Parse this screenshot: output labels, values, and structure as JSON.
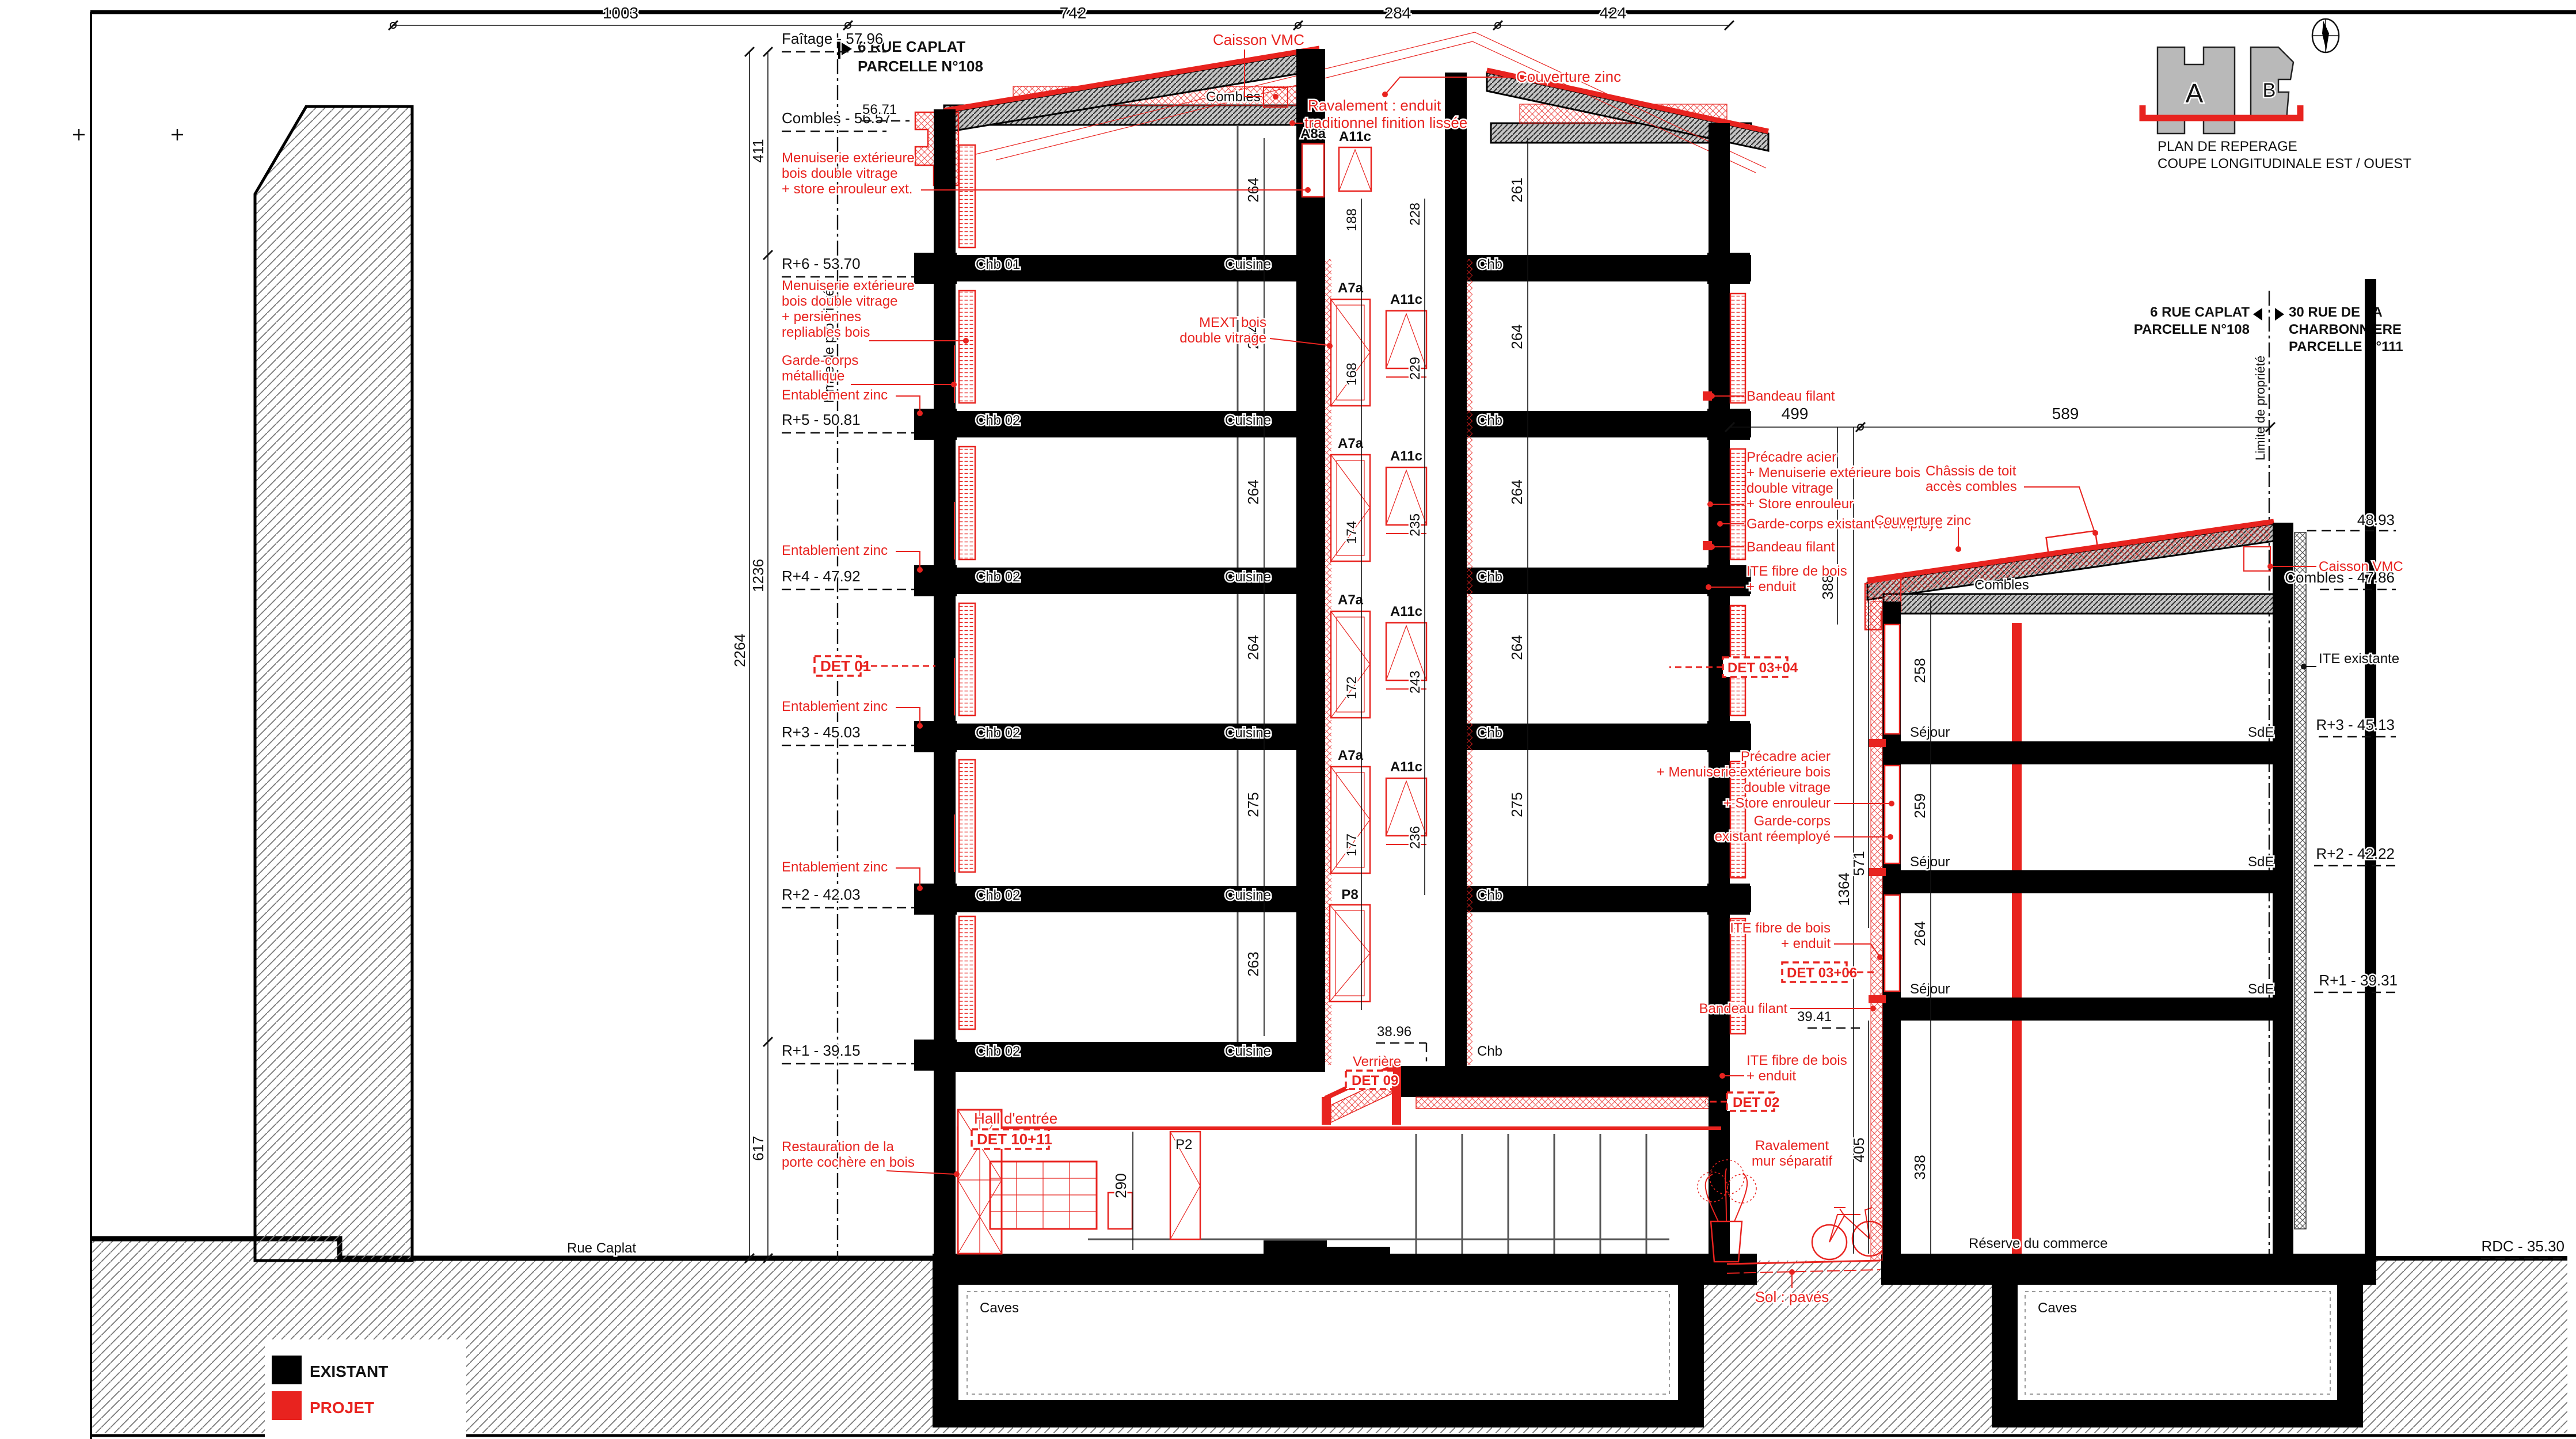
{
  "colors": {
    "project": "#e8231f",
    "existing": "#000000"
  },
  "legend": {
    "existing": "EXISTANT",
    "project": "PROJET"
  },
  "street": "Rue Caplat",
  "key_plan": {
    "line1": "PLAN DE REPERAGE",
    "line2": "COUPE LONGITUDINALE EST / OUEST",
    "block_a": "A",
    "block_b": "B"
  },
  "parcels": {
    "left_street": "6 RUE CAPLAT",
    "left_parcel": "PARCELLE N°108",
    "right_street1": "30 RUE DE LA",
    "right_street2": "CHARBONNIERE",
    "right_parcel": "PARCELLE N°111",
    "limit": "Limite de propriété"
  },
  "top_dims": {
    "d1": "1003",
    "d2": "742",
    "d3": "284",
    "d4": "424"
  },
  "left_dims": {
    "d1": "411",
    "d2": "1236",
    "d3": "2264",
    "d4": "617"
  },
  "levels_left": {
    "faitage": "Faîtage - 57.96",
    "combles": "Combles - 56.57",
    "l5671": "56.71",
    "r6": "R+6 - 53.70",
    "r5": "R+5 - 50.81",
    "r4": "R+4 - 47.92",
    "r3": "R+3 - 45.03",
    "r2": "R+2 - 42.03",
    "r1": "R+1 - 39.15",
    "l3896": "38.96"
  },
  "levels_right": {
    "l4893": "48.93",
    "combles": "Combles - 47.86",
    "r3": "R+3 - 45.13",
    "r2": "R+2 - 42.22",
    "r1": "R+1 - 39.31",
    "rdc": "RDC - 35.30",
    "l3941": "39.41"
  },
  "ann_left": {
    "men1a": "Menuiserie extérieure",
    "men1b": "bois double vitrage",
    "men1c": "+ store enrouleur ext.",
    "men2a": "Menuiserie extérieure",
    "men2b": "bois double vitrage",
    "men2c": "+ persiennes",
    "men2d": "repliables bois",
    "gc1a": "Garde-corps",
    "gc1b": "métallique",
    "entablement": "Entablement zinc",
    "det01": "DET 01",
    "resta": "Restauration de la",
    "restb": "porte cochère en bois"
  },
  "ann_center": {
    "caisson": "Caisson VMC",
    "rav1": "Ravalement : enduit",
    "rav2": "traditionnel finition lissée",
    "couverture": "Couverture zinc",
    "mext1": "MEXT bois",
    "mext2": "double vitrage",
    "verriere": "Verrière",
    "det09": "DET 09",
    "hall": "Hall d'entrée",
    "det1011": "DET 10+11"
  },
  "ann_right": {
    "bandeau": "Bandeau filant",
    "pre1": "Précadre acier",
    "pre2": "+ Menuiserie extérieure bois",
    "pre3": "double vitrage",
    "pre4": "+ Store enrouleur",
    "gc_re1": "Garde-corps existant réemployé",
    "gc2a": "Garde-corps",
    "gc2b": "existant réemployé",
    "ite1": "ITE fibre de bois",
    "ite2": "+ enduit",
    "det0304": "DET 03+04",
    "det0306": "DET 03+06",
    "det02": "DET 02",
    "chassis1": "Châssis de toit",
    "chassis2": "accès combles",
    "rav_sep1": "Ravalement",
    "rav_sep2": "mur séparatif",
    "sol": "Sol : pavés",
    "ite_exist": "ITE existante",
    "caisson": "Caisson VMC",
    "couverture": "Couverture zinc"
  },
  "rooms": {
    "chb01": "Chb 01",
    "chb02": "Chb 02",
    "chb": "Chb",
    "cuisine": "Cuisine",
    "combles": "Combles",
    "sejour": "Séjour",
    "sde": "SdE",
    "caves": "Caves",
    "reserve": "Réserve du commerce"
  },
  "windows": {
    "a8a": "A8a",
    "a7a": "A7a",
    "a11c": "A11c",
    "p8": "P8",
    "p2": "P2"
  },
  "dims_a": {
    "left_rooms": [
      "264",
      "264",
      "264",
      "264",
      "275",
      "263"
    ],
    "rdc": "290",
    "right_rooms": [
      "261",
      "264",
      "264",
      "264",
      "275"
    ],
    "shaft_top": [
      "188",
      "228"
    ],
    "shaft_left": [
      "168",
      "174",
      "172",
      "177"
    ],
    "shaft_right": [
      "229",
      "235",
      "243",
      "236"
    ]
  },
  "dims_b": {
    "top": [
      "499",
      "589"
    ],
    "chains": [
      "388",
      "1364",
      "571",
      "405"
    ],
    "rooms": [
      "258",
      "259",
      "264",
      "338"
    ]
  }
}
